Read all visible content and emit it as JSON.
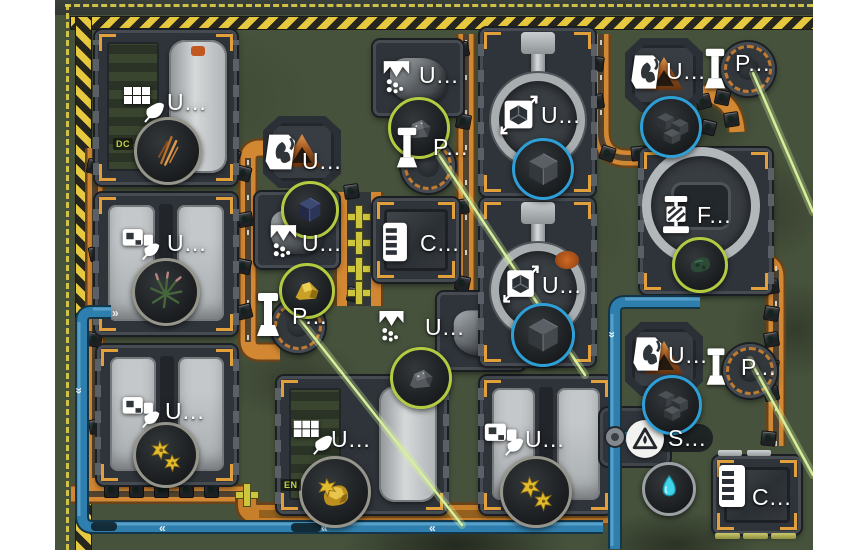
{
  "scene": {
    "background": "#ffffff",
    "terrain": "#46523c"
  },
  "colors": {
    "belt": "#d28732",
    "belt_dark": "#69441a",
    "belt_center": "#3b372f",
    "pipe": "#2f7fae",
    "pipe_dark": "#143648",
    "pipe_light": "#5fa8cf",
    "beam": "#d6ef9b",
    "hazard_yellow": "#e6c93f",
    "hazard_dark": "#26261e",
    "bracket_orange": "#e2a03c",
    "label_text": "#ffffff",
    "ring_gray": "#95958b",
    "ring_green": "#b2cb41",
    "ring_blue": "#2d9fd6",
    "ring_gray2": "#9aa0a4"
  },
  "pipes": {
    "left_chevron": "«",
    "right_chevron": "»"
  },
  "buildings": [
    {
      "id": "greenhouse-1",
      "type": "farm-a",
      "label": "U...",
      "icon": "solar-leaf",
      "x": 40,
      "y": 30,
      "w": 142,
      "h": 155,
      "lx": 112,
      "ly": 89,
      "ix": 64,
      "iy": 80,
      "iw": 48,
      "ih": 48,
      "status": "DC",
      "sx": 58,
      "sy": 138
    },
    {
      "id": "greenhouse-2",
      "type": "farm-b",
      "label": "U...",
      "icon": "harvester-leaf",
      "x": 40,
      "y": 193,
      "w": 142,
      "h": 142,
      "lx": 112,
      "ly": 230,
      "ix": 64,
      "iy": 220,
      "iw": 44,
      "ih": 44
    },
    {
      "id": "greenhouse-3",
      "type": "farm-b",
      "label": "U...",
      "icon": "harvester-leaf",
      "x": 42,
      "y": 345,
      "w": 140,
      "h": 140,
      "lx": 110,
      "ly": 398,
      "ix": 64,
      "iy": 388,
      "iw": 44,
      "ih": 44
    },
    {
      "id": "greenhouse-4",
      "type": "farm-a",
      "label": "U...",
      "icon": "solar-leaf",
      "x": 222,
      "y": 376,
      "w": 170,
      "h": 138,
      "lx": 276,
      "ly": 426,
      "ix": 234,
      "iy": 414,
      "iw": 46,
      "ih": 46,
      "status": "EN",
      "sx": 226,
      "sy": 479
    },
    {
      "id": "greenhouse-5",
      "type": "farm-b",
      "label": "U...",
      "icon": "harvester-leaf",
      "x": 425,
      "y": 376,
      "w": 132,
      "h": 138,
      "lx": 470,
      "ly": 426,
      "ix": 426,
      "iy": 414,
      "iw": 46,
      "ih": 46
    },
    {
      "id": "smelter-1",
      "type": "smelter",
      "label": "U...",
      "icon": "furnace",
      "x": 208,
      "y": 116,
      "w": 78,
      "h": 72,
      "lx": 247,
      "ly": 148,
      "ix": 206,
      "iy": 128,
      "iw": 44,
      "ih": 48
    },
    {
      "id": "crusher-1",
      "type": "crusher",
      "label": "U...",
      "icon": "crusher",
      "x": 200,
      "y": 192,
      "w": 84,
      "h": 76,
      "lx": 247,
      "ly": 230,
      "ix": 211,
      "iy": 218,
      "iw": 38,
      "ih": 46
    },
    {
      "id": "press-1",
      "type": "press",
      "label": "P...",
      "icon": "piston",
      "x": 216,
      "y": 299,
      "w": 54,
      "h": 54,
      "lx": 237,
      "ly": 303,
      "ix": 200,
      "iy": 289,
      "iw": 26,
      "ih": 52
    },
    {
      "id": "crusher-2",
      "type": "crusher",
      "label": "U...",
      "icon": "crusher",
      "x": 318,
      "y": 40,
      "w": 90,
      "h": 76,
      "lx": 364,
      "ly": 62,
      "ix": 324,
      "iy": 54,
      "iw": 38,
      "ih": 46
    },
    {
      "id": "press-2",
      "type": "press",
      "label": "P...",
      "icon": "piston",
      "x": 346,
      "y": 139,
      "w": 54,
      "h": 54,
      "lx": 378,
      "ly": 134,
      "ix": 340,
      "iy": 124,
      "iw": 24,
      "ih": 48
    },
    {
      "id": "storage-1",
      "type": "container",
      "label": "C...",
      "icon": "container",
      "x": 318,
      "y": 198,
      "w": 86,
      "h": 84,
      "lx": 365,
      "ly": 230,
      "ix": 325,
      "iy": 220,
      "iw": 30,
      "ih": 44
    },
    {
      "id": "crusher-3",
      "type": "crusher",
      "label": "U...",
      "icon": "crusher",
      "x": 382,
      "y": 292,
      "w": 88,
      "h": 78,
      "lx": 370,
      "ly": 314,
      "ix": 320,
      "iy": 304,
      "iw": 36,
      "ih": 44
    },
    {
      "id": "unpacker-1",
      "type": "unpacker",
      "label": "U...",
      "icon": "packer",
      "x": 425,
      "y": 28,
      "w": 115,
      "h": 168,
      "lx": 486,
      "ly": 102,
      "ix": 441,
      "iy": 92,
      "iw": 46,
      "ih": 46
    },
    {
      "id": "unpacker-2",
      "type": "unpacker",
      "accent": true,
      "label": "U...",
      "icon": "packer",
      "x": 425,
      "y": 198,
      "w": 115,
      "h": 168,
      "lx": 487,
      "ly": 272,
      "ix": 444,
      "iy": 262,
      "iw": 44,
      "ih": 44
    },
    {
      "id": "smelter-2",
      "type": "smelter",
      "label": "U...",
      "icon": "furnace",
      "x": 570,
      "y": 38,
      "w": 78,
      "h": 74,
      "lx": 611,
      "ly": 58,
      "ix": 572,
      "iy": 48,
      "iw": 42,
      "ih": 48
    },
    {
      "id": "press-3",
      "type": "press",
      "label": "P...",
      "icon": "piston",
      "x": 666,
      "y": 42,
      "w": 54,
      "h": 54,
      "lx": 680,
      "ly": 50,
      "ix": 648,
      "iy": 44,
      "iw": 24,
      "ih": 50
    },
    {
      "id": "filter-1",
      "type": "filter",
      "label": "F...",
      "icon": "filter-press",
      "x": 585,
      "y": 148,
      "w": 132,
      "h": 146,
      "lx": 642,
      "ly": 202,
      "ix": 602,
      "iy": 192,
      "iw": 38,
      "ih": 46
    },
    {
      "id": "smelter-3",
      "type": "smelter",
      "label": "U...",
      "icon": "furnace",
      "x": 570,
      "y": 322,
      "w": 78,
      "h": 74,
      "lx": 613,
      "ly": 342,
      "ix": 574,
      "iy": 330,
      "iw": 42,
      "ih": 48
    },
    {
      "id": "press-4",
      "type": "press",
      "label": "P...",
      "icon": "piston",
      "x": 668,
      "y": 344,
      "w": 54,
      "h": 54,
      "lx": 686,
      "ly": 354,
      "ix": 650,
      "iy": 344,
      "iw": 22,
      "ih": 46
    },
    {
      "id": "water-pump-1",
      "type": "pump",
      "label": "S...",
      "icon": "pump",
      "x": 545,
      "y": 408,
      "w": 70,
      "h": 58,
      "lx": 613,
      "ly": 425
    },
    {
      "id": "storage-2",
      "type": "container",
      "label": "C...",
      "icon": "container",
      "x": 658,
      "y": 456,
      "w": 88,
      "h": 78,
      "lx": 697,
      "ly": 484,
      "ix": 662,
      "iy": 462,
      "iw": 30,
      "ih": 48,
      "slats": true
    }
  ],
  "items": [
    {
      "id": "copper-fiber-plant",
      "glyph": "copper-needles",
      "ring": "gray",
      "x": 110,
      "y": 148,
      "r": 31
    },
    {
      "id": "spike-plant",
      "glyph": "spiky-plant",
      "ring": "gray",
      "x": 108,
      "y": 289,
      "r": 31
    },
    {
      "id": "yellow-flower-1",
      "glyph": "flowers",
      "ring": "gray",
      "x": 108,
      "y": 452,
      "r": 30
    },
    {
      "id": "gold-ore-plant",
      "glyph": "gold-ore-flower",
      "ring": "gray",
      "x": 277,
      "y": 489,
      "r": 33
    },
    {
      "id": "yellow-flower-2",
      "glyph": "flowers",
      "ring": "gray",
      "x": 478,
      "y": 489,
      "r": 33
    },
    {
      "id": "dark-ore-cube",
      "glyph": "navy-cube",
      "ring": "green",
      "x": 252,
      "y": 207,
      "r": 26
    },
    {
      "id": "gold-ore",
      "glyph": "gold-ore",
      "ring": "green",
      "x": 249,
      "y": 288,
      "r": 25
    },
    {
      "id": "stone-1",
      "glyph": "rock",
      "ring": "green",
      "x": 361,
      "y": 125,
      "r": 28
    },
    {
      "id": "stone-2",
      "glyph": "rock",
      "ring": "green",
      "x": 363,
      "y": 375,
      "r": 28
    },
    {
      "id": "cube-1",
      "glyph": "big-cube",
      "ring": "blue",
      "x": 485,
      "y": 166,
      "r": 28
    },
    {
      "id": "cube-2",
      "glyph": "big-cube",
      "ring": "blue",
      "x": 485,
      "y": 332,
      "r": 29
    },
    {
      "id": "cube-stack-1",
      "glyph": "cube-cluster",
      "ring": "blue",
      "x": 613,
      "y": 124,
      "r": 28
    },
    {
      "id": "cube-stack-2",
      "glyph": "cube-cluster",
      "ring": "blue",
      "x": 614,
      "y": 402,
      "r": 27
    },
    {
      "id": "biomass",
      "glyph": "green-clump",
      "ring": "green",
      "x": 642,
      "y": 262,
      "r": 25
    },
    {
      "id": "water",
      "glyph": "water-drop",
      "ring": "gray2",
      "x": 611,
      "y": 486,
      "r": 24
    }
  ],
  "crates": [
    [
      38,
      165,
      10
    ],
    [
      40,
      252,
      -12
    ],
    [
      38,
      338,
      8
    ],
    [
      40,
      425,
      -8
    ],
    [
      187,
      172,
      15
    ],
    [
      189,
      218,
      -10
    ],
    [
      187,
      265,
      12
    ],
    [
      188,
      310,
      -14
    ],
    [
      176,
      155,
      20
    ],
    [
      295,
      190,
      -8
    ],
    [
      298,
      293,
      10
    ],
    [
      405,
      48,
      -12
    ],
    [
      407,
      120,
      10
    ],
    [
      405,
      205,
      -8
    ],
    [
      406,
      282,
      12
    ],
    [
      405,
      345,
      -10
    ],
    [
      540,
      62,
      8
    ],
    [
      540,
      100,
      -10
    ],
    [
      551,
      152,
      18
    ],
    [
      582,
      152,
      -6
    ],
    [
      612,
      146,
      10
    ],
    [
      715,
      285,
      -8
    ],
    [
      715,
      312,
      10
    ],
    [
      715,
      338,
      -10
    ],
    [
      715,
      365,
      8
    ],
    [
      715,
      392,
      -12
    ],
    [
      712,
      437,
      6
    ],
    [
      647,
      100,
      -15
    ],
    [
      666,
      96,
      12
    ],
    [
      675,
      118,
      -8
    ],
    [
      652,
      126,
      14
    ],
    [
      55,
      489,
      0
    ],
    [
      80,
      489,
      0
    ],
    [
      105,
      489,
      0
    ],
    [
      130,
      489,
      0
    ],
    [
      155,
      489,
      0
    ],
    [
      345,
      492,
      5
    ],
    [
      370,
      492,
      -5
    ]
  ],
  "splitters": [
    [
      293,
      206
    ],
    [
      293,
      232
    ],
    [
      293,
      258
    ],
    [
      293,
      282
    ],
    [
      181,
      484
    ]
  ]
}
